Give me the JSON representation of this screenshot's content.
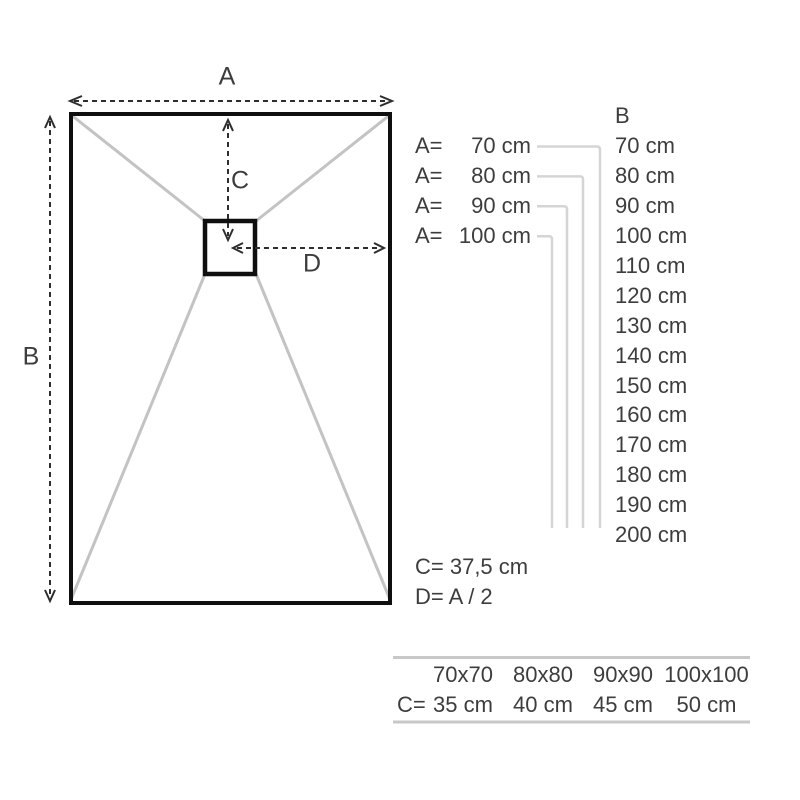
{
  "diagram": {
    "labels": {
      "a": "A",
      "b": "B",
      "c": "C",
      "d": "D"
    }
  },
  "width_options": [
    {
      "prefix": "A=",
      "value": "70 cm"
    },
    {
      "prefix": "A=",
      "value": "80 cm"
    },
    {
      "prefix": "A=",
      "value": "90 cm"
    },
    {
      "prefix": "A=",
      "value": "100 cm"
    }
  ],
  "length_column": {
    "header": "B",
    "values": [
      "70 cm",
      "80 cm",
      "90 cm",
      "100 cm",
      "110 cm",
      "120 cm",
      "130 cm",
      "140 cm",
      "150 cm",
      "160 cm",
      "170 cm",
      "180 cm",
      "190 cm",
      "200 cm"
    ]
  },
  "formulas": {
    "c": "C= 37,5 cm",
    "d": "D= A / 2"
  },
  "square_table": {
    "row_prefix": "C=",
    "sizes": [
      "70x70",
      "80x80",
      "90x90",
      "100x100"
    ],
    "c_values": [
      "35 cm",
      "40 cm",
      "45 cm",
      "50 cm"
    ]
  },
  "colors": {
    "outline": "#0f0f0f",
    "text": "#3d3d3d",
    "corner_guides": "#c3c3c3",
    "leader_lines": "#d5d5d5",
    "table_rules": "#c8c8c8",
    "dashed_arrows": "#2e2e2e"
  }
}
